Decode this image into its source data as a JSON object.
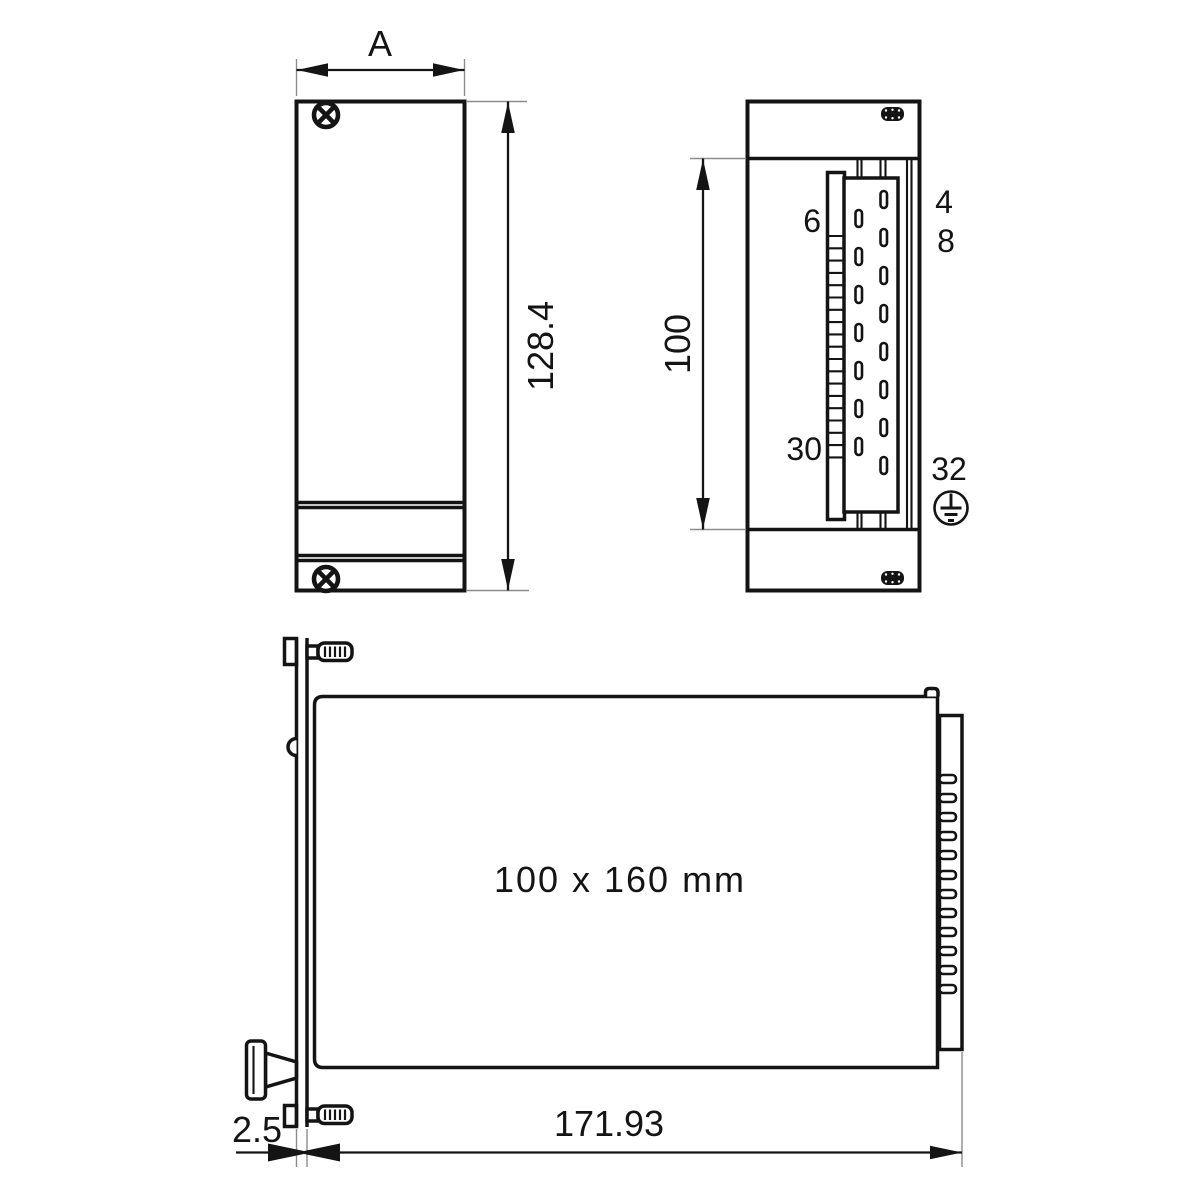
{
  "drawing": {
    "front_view": {
      "width_label": "A",
      "height_label": "128.4"
    },
    "rear_view": {
      "height_label": "100",
      "pin_top_inner": "6",
      "pin_top_outer_row1": "4",
      "pin_top_outer_row2": "8",
      "pin_bottom_inner": "30",
      "pin_bottom_outer": "32"
    },
    "side_view": {
      "board_label": "100 x 160 mm",
      "depth_label": "171.93",
      "panel_thickness_label": "2.5"
    },
    "colors": {
      "line": "#141414",
      "extension_line": "#8c8c8c",
      "background": "#ffffff"
    }
  }
}
